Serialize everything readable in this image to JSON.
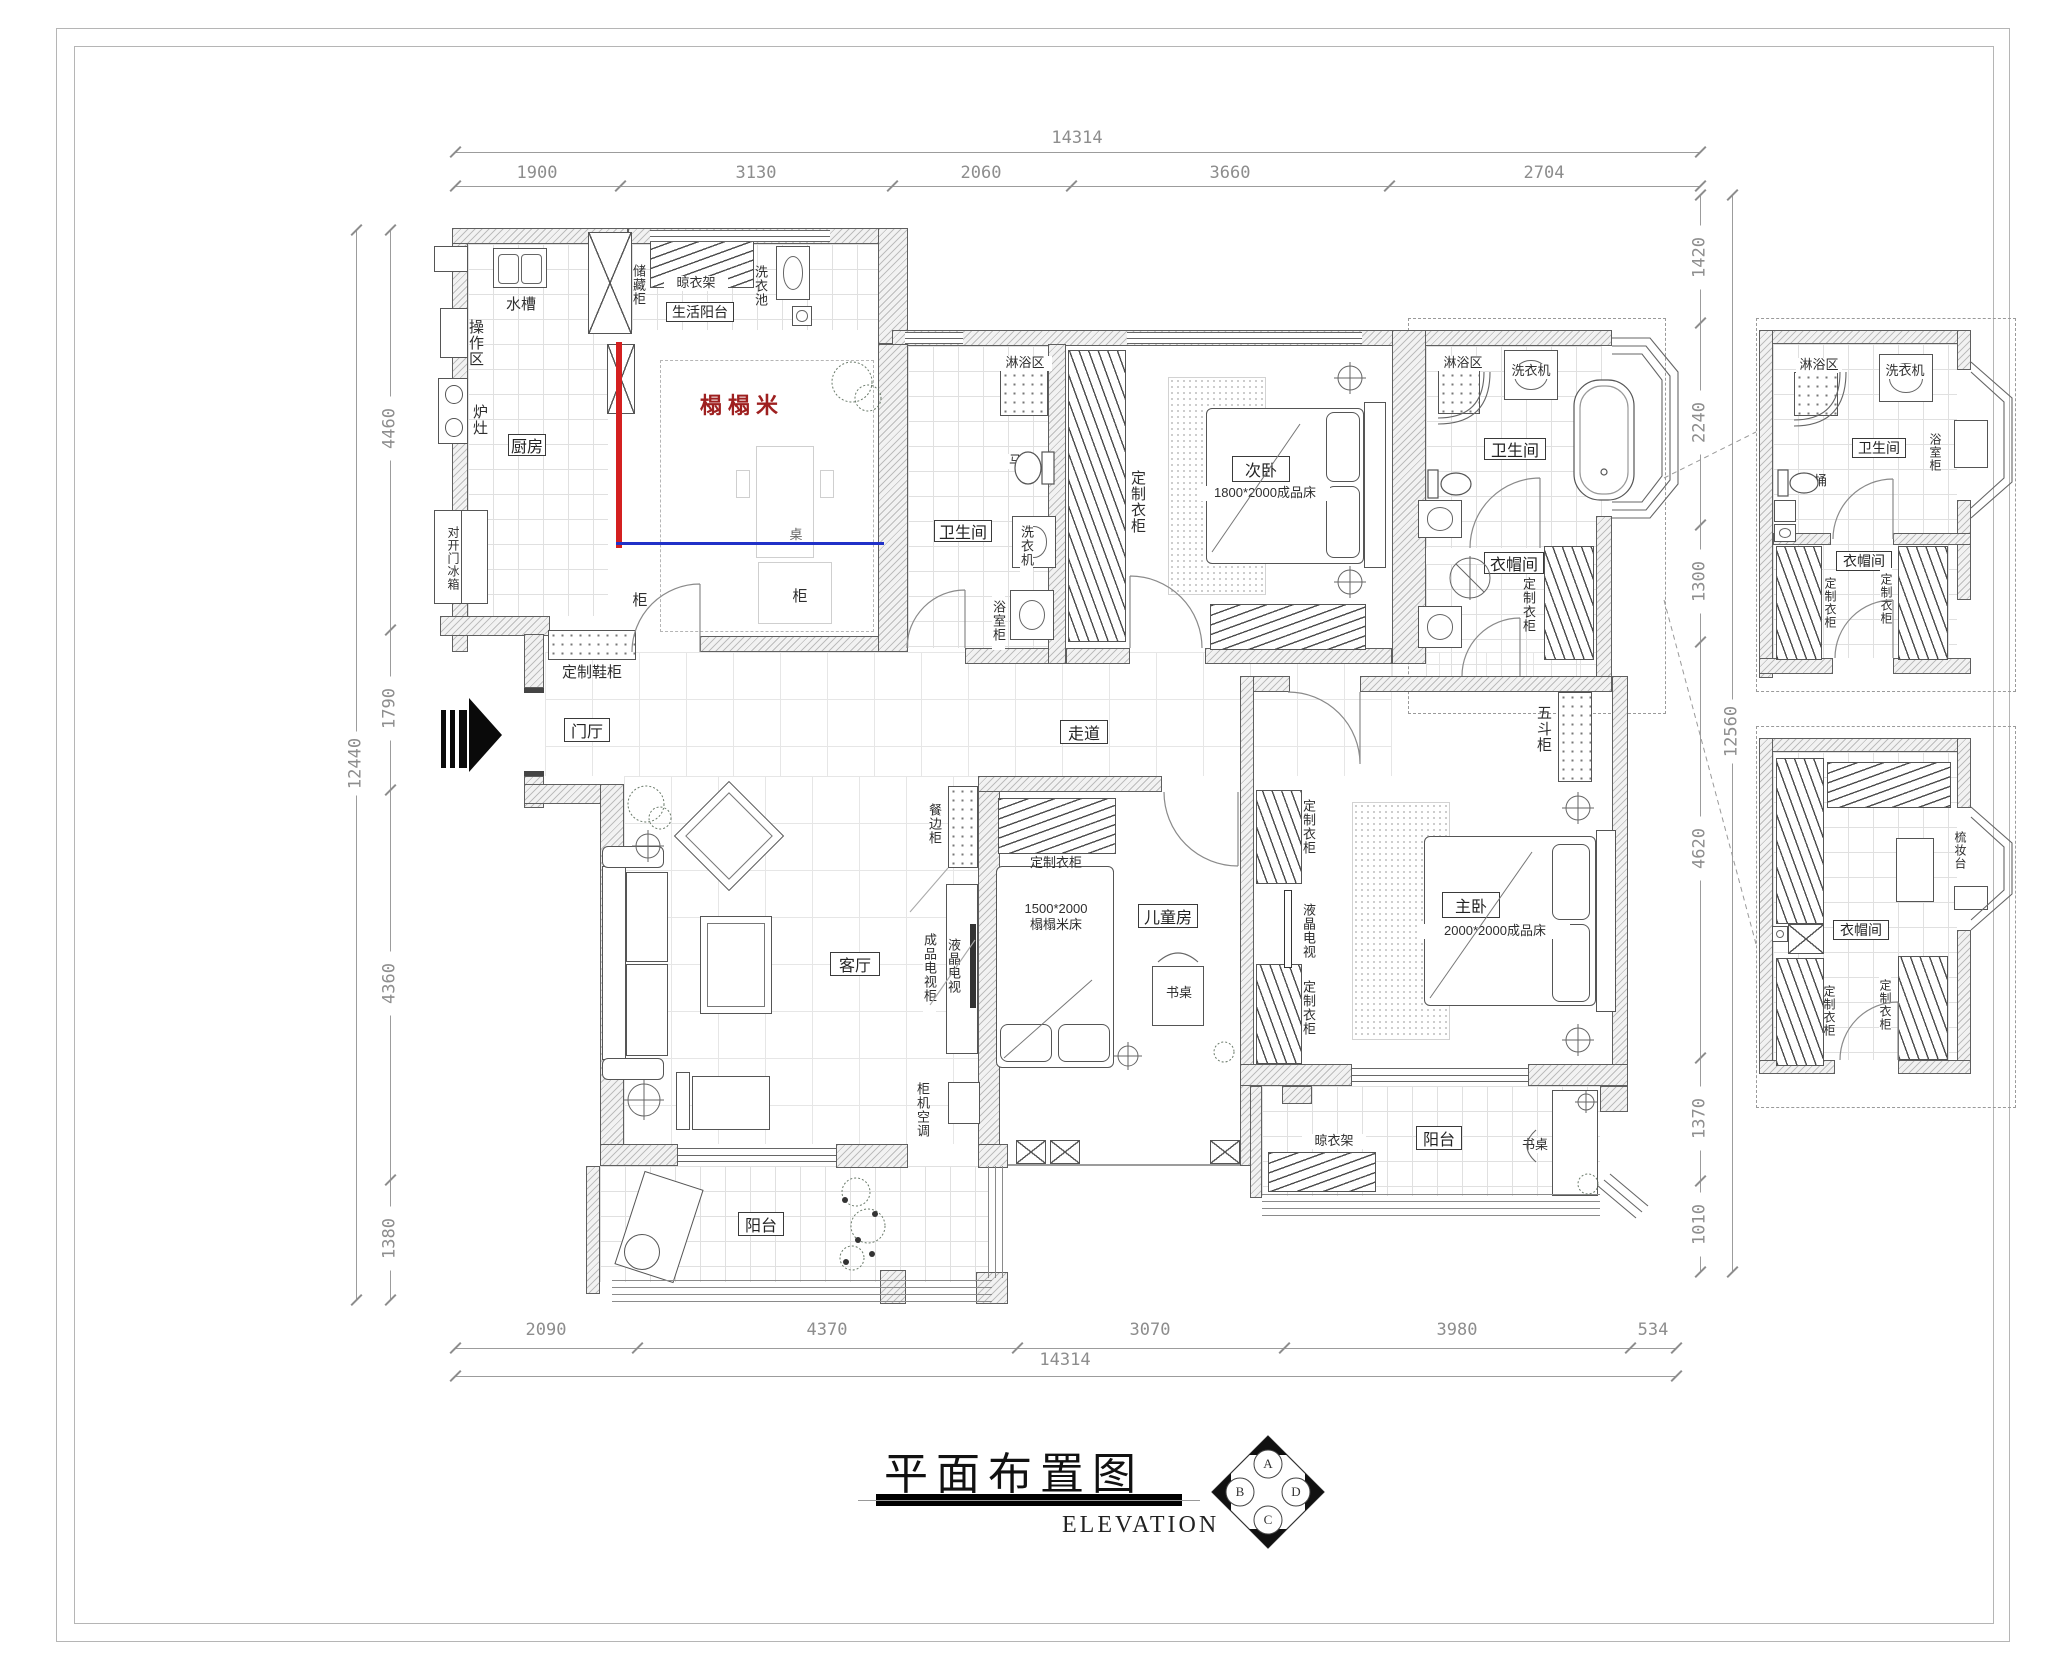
{
  "page": {
    "title": "平面布置图",
    "subtitle": "ELEVATION"
  },
  "compass": {
    "n": "A",
    "w": "B",
    "e": "D",
    "s": "C"
  },
  "dims": {
    "top_total": "14314",
    "bottom_total": "14314",
    "left_total": "12440",
    "right_total": "12560",
    "top": [
      "1900",
      "3130",
      "2060",
      "3660",
      "2704"
    ],
    "bottom": [
      "2090",
      "4370",
      "3070",
      "3980",
      "534"
    ],
    "left": [
      "4460",
      "1790",
      "4360",
      "1380"
    ],
    "right": [
      "1420",
      "2240",
      "1300",
      "4620",
      "1370",
      "1010"
    ]
  },
  "rooms": {
    "kitchen": {
      "name": "厨房",
      "sink": "水槽",
      "work": "操作区",
      "stove": "炉灶",
      "fridge": "对开门冰箱"
    },
    "service_balcony": {
      "name": "生活阳台",
      "storage": "储藏柜",
      "rack": "晾衣架",
      "basin": "洗衣池"
    },
    "tatami": {
      "note": "榻榻米",
      "table_char": "桌",
      "cab_char": "柜"
    },
    "bath1": {
      "name": "卫生间",
      "shower": "淋浴区",
      "toilet": "马桶",
      "washer": "洗衣机",
      "vanity": "浴室柜"
    },
    "bedroom2": {
      "name": "次卧",
      "bed": "1800*2000成品床",
      "wardrobe": "定制衣柜"
    },
    "bath2": {
      "name": "卫生间",
      "shower": "淋浴区",
      "washer": "洗衣机",
      "tub": "浴缸"
    },
    "cloak": {
      "name": "衣帽间",
      "wardrobe": "定制衣柜"
    },
    "foyer": {
      "name": "门厅",
      "shoe": "定制鞋柜"
    },
    "corridor": {
      "name": "走道",
      "chest": "五斗柜"
    },
    "living": {
      "name": "客厅",
      "sideboard": "餐边柜",
      "tv_stand": "成品电视柜",
      "tv": "液晶电视",
      "ac": "柜机空调"
    },
    "kids": {
      "name": "儿童房",
      "wardrobe": "定制衣柜",
      "bed_size": "1500*2000",
      "bed_type": "榻榻米床",
      "desk": "书桌"
    },
    "master": {
      "name": "主卧",
      "bed": "2000*2000成品床",
      "wardrobe": "定制衣柜",
      "tv": "液晶电视"
    },
    "balcony_left": {
      "name": "阳台"
    },
    "balcony_right": {
      "name": "阳台",
      "rack": "晾衣架",
      "desk": "书桌"
    }
  },
  "details": {
    "bath": {
      "name": "卫生间",
      "shower": "淋浴区",
      "washer": "洗衣机",
      "vanity": "浴室柜",
      "toilet": "马桶"
    },
    "cloak_top": {
      "name": "衣帽间",
      "wardrobe_left": "定制衣柜",
      "wardrobe_right": "定制衣柜"
    },
    "cloak_bottom": {
      "name": "衣帽间",
      "dresser": "梳妆台",
      "wardrobe_left": "定制衣柜",
      "wardrobe_right": "定制衣柜"
    }
  },
  "colors": {
    "line_red": "#d42020",
    "line_blue": "#2031c8",
    "tatami_text": "#9e2020",
    "wall_hatch": "#bdbdbd"
  }
}
